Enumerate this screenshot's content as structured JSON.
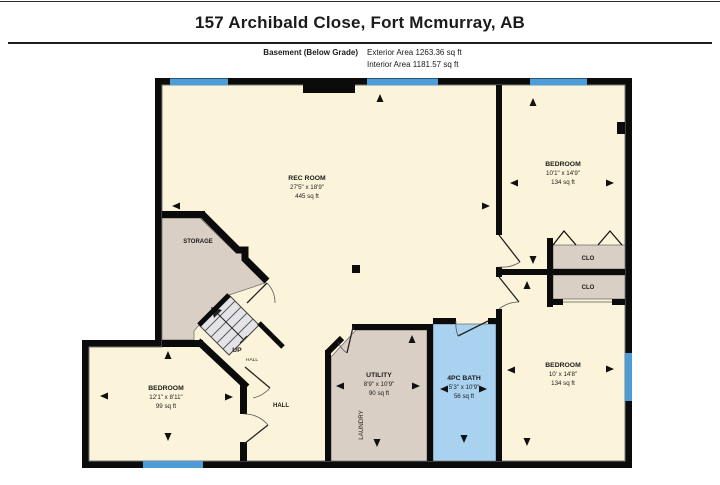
{
  "header": {
    "title": "157 Archibald Close, Fort Mcmurray, AB",
    "floor_label": "Basement (Below Grade)",
    "exterior_area": "Exterior Area 1263.36 sq ft",
    "interior_area": "Interior Area 1181.57 sq ft"
  },
  "colors": {
    "wall": "#0b0b0b",
    "room_fill": "#FBF4DA",
    "storage_fill": "#D9CFC4",
    "bath_fill": "#A9D2F1",
    "window_fill": "#4E9CD6",
    "stairs_fill": "#E4E4E8"
  },
  "rooms": {
    "rec_room": {
      "name": "REC ROOM",
      "dims": "27'5\" x 18'9\"",
      "area": "445 sq ft"
    },
    "storage": {
      "name": "STORAGE"
    },
    "bedroom_top_right": {
      "name": "BEDROOM",
      "dims": "10'1\" x 14'9\"",
      "area": "134 sq ft"
    },
    "bedroom_bottom_right": {
      "name": "BEDROOM",
      "dims": "10' x 14'8\"",
      "area": "134 sq ft"
    },
    "bedroom_bottom_left": {
      "name": "BEDROOM",
      "dims": "12'1\" x 8'11\"",
      "area": "99 sq ft"
    },
    "utility": {
      "name": "UTILITY",
      "dims": "8'9\" x 10'9\"",
      "area": "90 sq ft"
    },
    "bath": {
      "name": "4PC BATH",
      "dims": "5'3\" x 10'9\"",
      "area": "56 sq ft"
    },
    "laundry": {
      "name": "LAUNDRY"
    },
    "hall": {
      "name": "HALL"
    },
    "stair_hall": {
      "name": "HALL"
    },
    "stairs": {
      "label": "UP"
    },
    "closet_top": {
      "name": "CLO"
    },
    "closet_bottom": {
      "name": "CLO"
    }
  }
}
